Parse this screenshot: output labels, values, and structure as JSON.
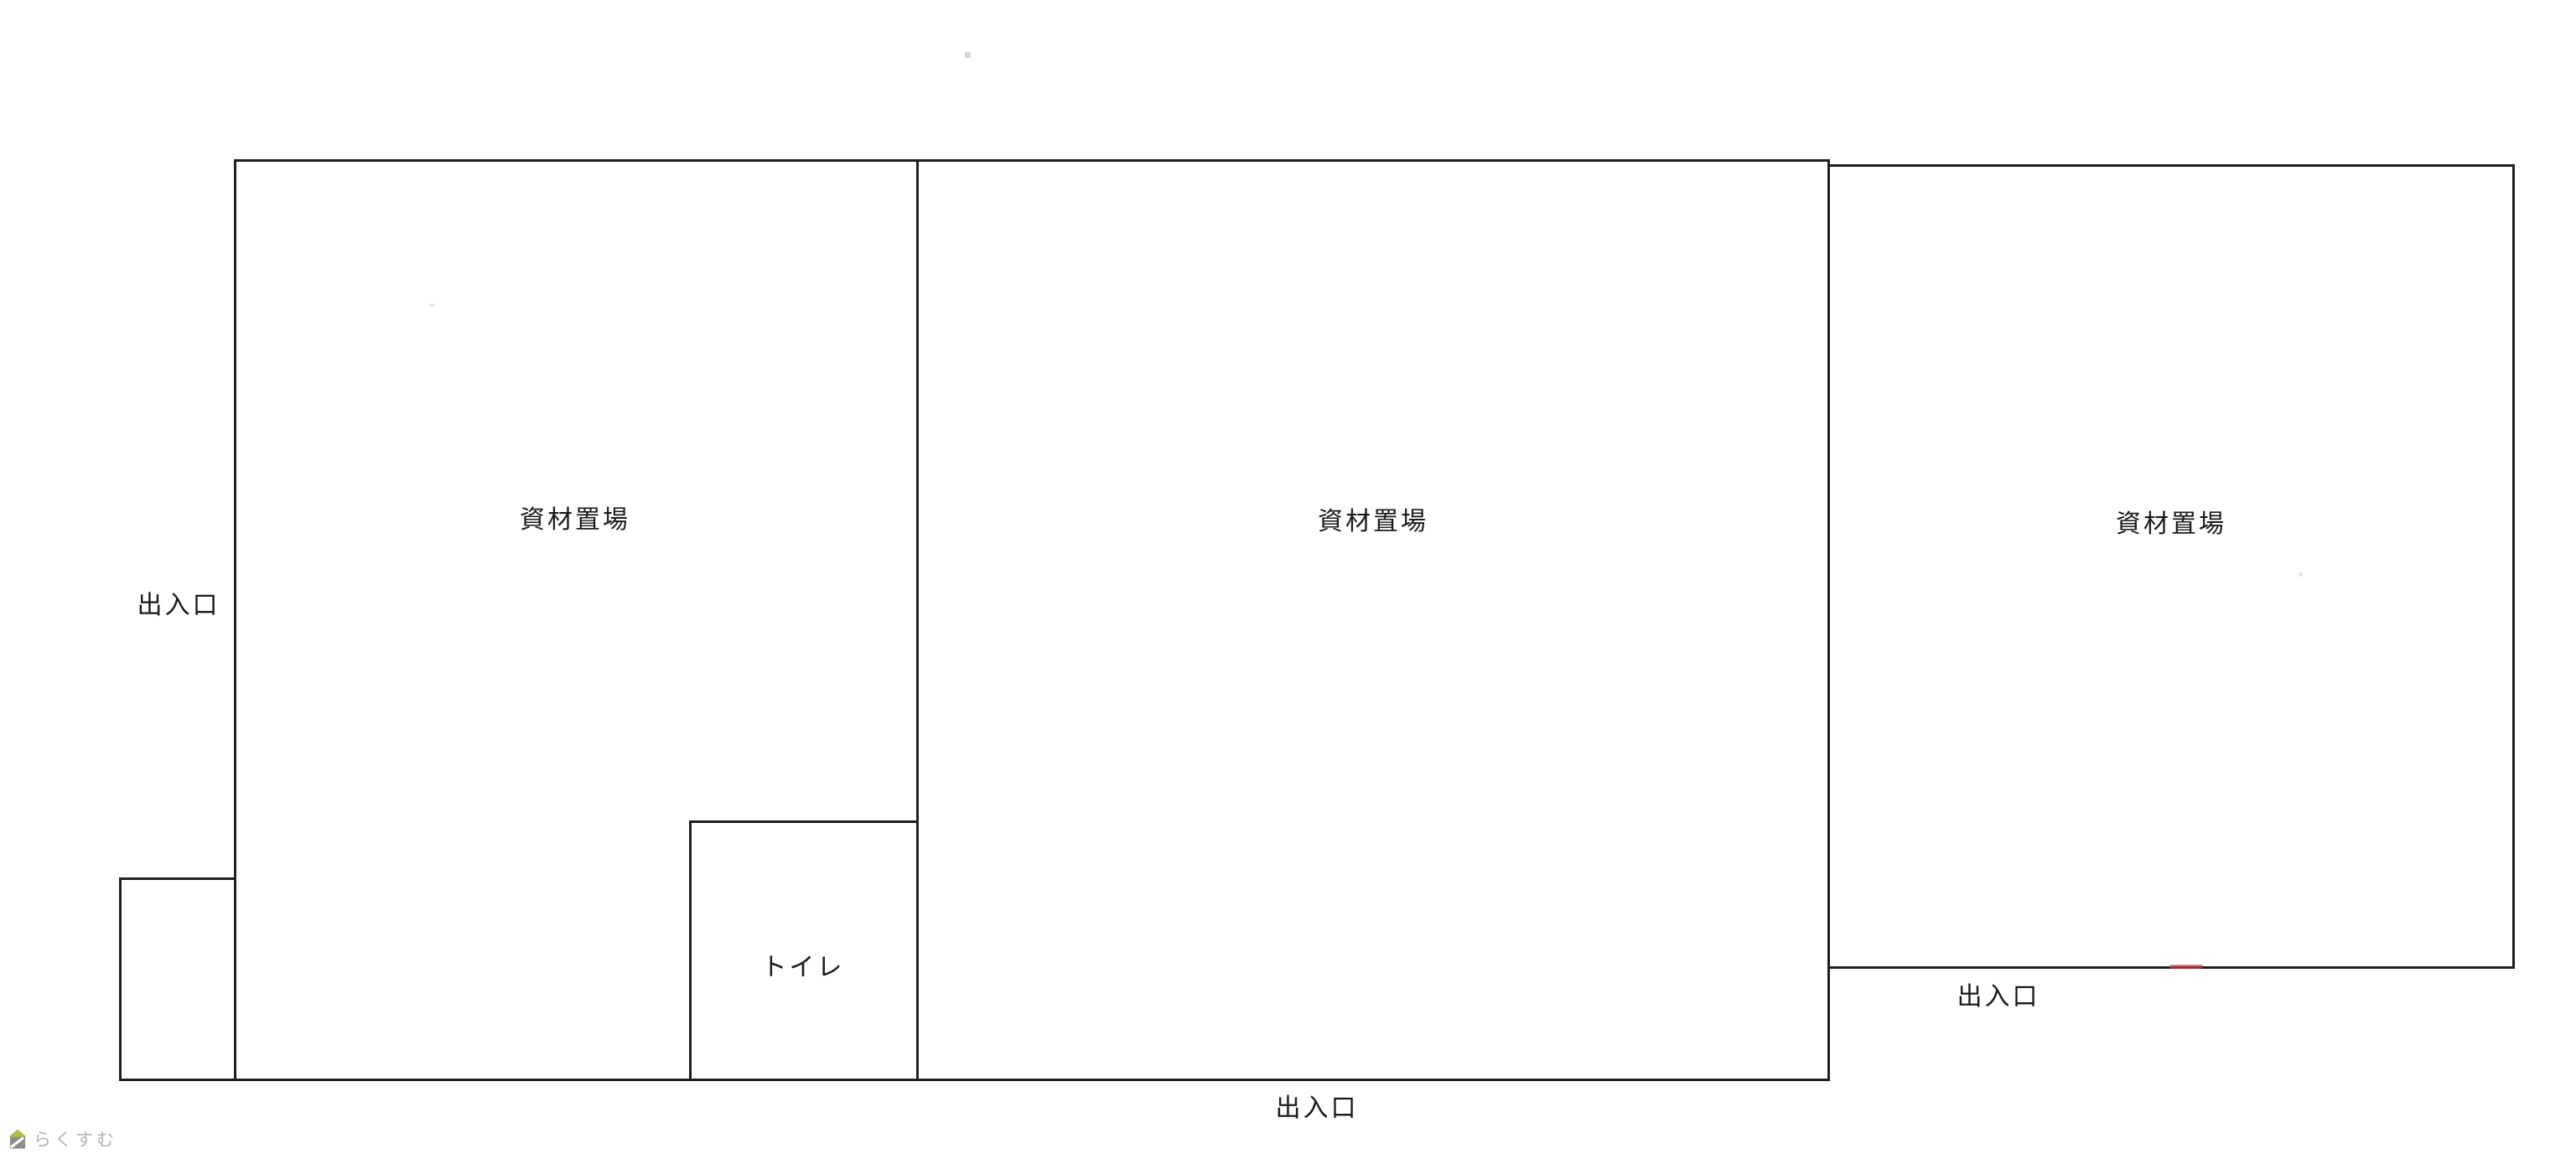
{
  "colors": {
    "page-bg": "#ffffff",
    "wall-color": "#1f1f1f",
    "label-color": "#1a1a1a",
    "red-mark-color": "#d03a34",
    "watermark-text-color": "#b8b3ab",
    "watermark-roof-color": "#b2bd3b",
    "watermark-body-color": "#8f8f89"
  },
  "floorplan": {
    "rooms": [
      {
        "id": "storage-left",
        "label": "資材置場"
      },
      {
        "id": "storage-middle",
        "label": "資材置場"
      },
      {
        "id": "storage-right",
        "label": "資材置場"
      },
      {
        "id": "toilet",
        "label": "トイレ"
      },
      {
        "id": "annex",
        "label": ""
      }
    ],
    "entrances": [
      {
        "id": "entrance-left",
        "label": "出入口"
      },
      {
        "id": "entrance-bottom",
        "label": "出入口"
      },
      {
        "id": "entrance-right",
        "label": "出入口"
      }
    ]
  },
  "watermark": {
    "brand": "らくすむ",
    "icon": "house-icon"
  }
}
